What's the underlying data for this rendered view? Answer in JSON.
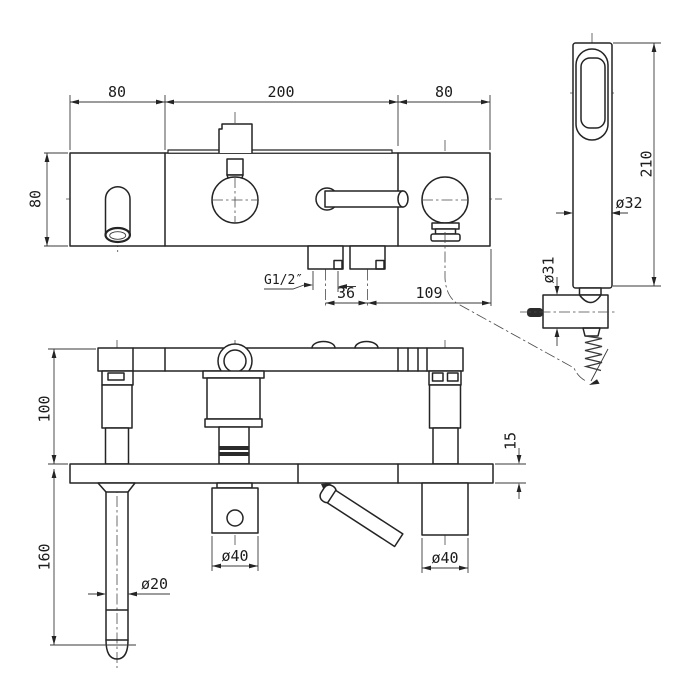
{
  "drawing_title": "bath-shower mixer technical dimension drawing",
  "front_view": {
    "dim_width_left": "80",
    "dim_width_center": "200",
    "dim_width_right": "80",
    "dim_body_height": "80",
    "thread_label": "G1/2″",
    "dim_inlet_spacing": "36",
    "dim_outlet_offset": "109"
  },
  "hand_shower": {
    "dim_length": "210",
    "dim_handle_diameter": "ø32",
    "dim_bracket_diameter": "ø31"
  },
  "side_view": {
    "dim_height_above_deck": "100",
    "dim_length_below_deck": "160",
    "dim_deck_thickness": "15",
    "dim_pipe_diameter": "ø20",
    "dim_left_valve_diameter": "ø40",
    "dim_right_valve_diameter": "ø40"
  }
}
